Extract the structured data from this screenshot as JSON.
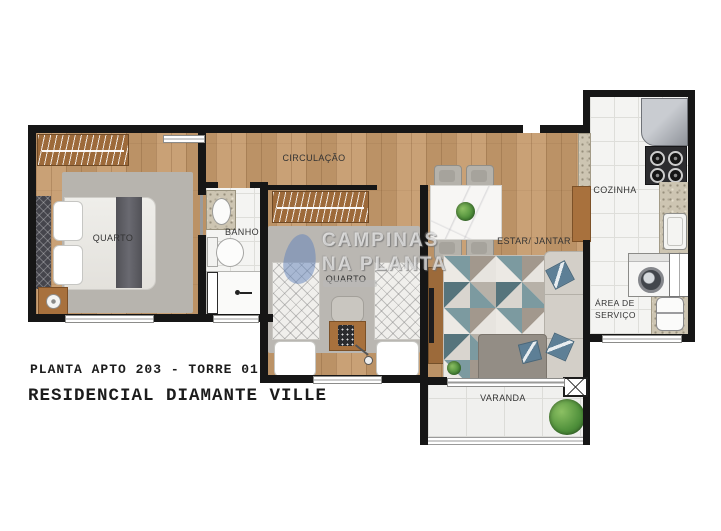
{
  "plan": {
    "labels": {
      "quarto1": "QUARTO",
      "banho": "BANHO",
      "circulacao": "CIRCULAÇÃO",
      "quarto2": "QUARTO",
      "estar_jantar": "ESTAR/ JANTAR",
      "cozinha": "COZINHA",
      "area_servico_line1": "ÁREA DE",
      "area_servico_line2": "SERVIÇO",
      "varanda": "VARANDA"
    }
  },
  "watermark": {
    "line1": "CAMPINAS",
    "line2": "NA PLANTA"
  },
  "footer": {
    "line1": "PLANTA APTO 203 - TORRE 01",
    "line2": "RESIDENCIAL DIAMANTE VILLE"
  },
  "colors": {
    "wall": "#161616",
    "wood_floor": "#c59a6c",
    "tile": "#f4f4f2",
    "granite": "#cdc5b2",
    "wardrobe_wood": "#9d6a3a",
    "rug_gray": "#b7b4ae",
    "rug_teal": "#7c9aa0",
    "pillow_blue": "#5d7f96",
    "plant_green": "#4e8f3a",
    "watermark_blue": "#5f82b9"
  }
}
